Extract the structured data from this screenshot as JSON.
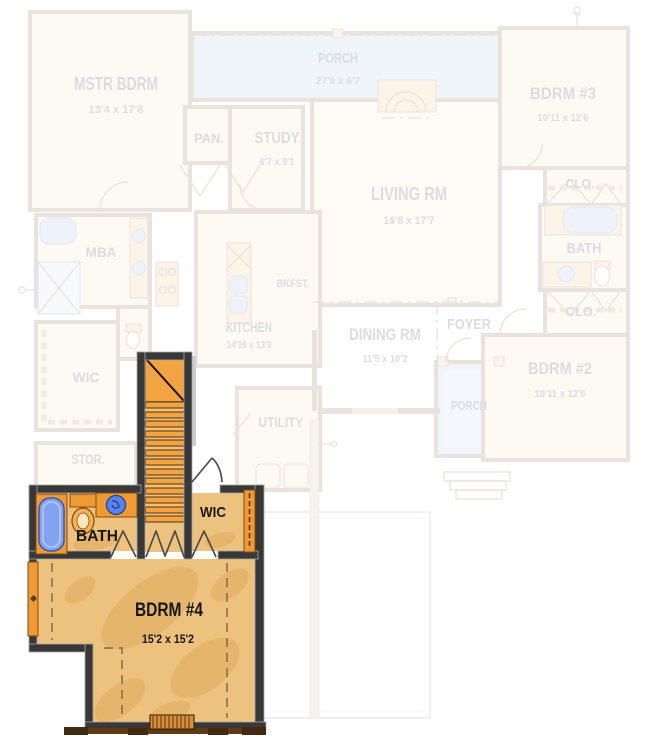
{
  "colors": {
    "page_bg": "#ffffff",
    "wall_dark": "#383838",
    "floor_tan": "#ecc27e",
    "floor_blob": "#e0ac5c",
    "stair_orange": "#f2a443",
    "stair_light": "#f7be72",
    "accent_orange": "#ed9b32",
    "accent_outline": "#8a4a10",
    "tub_blue": "#84a3ee",
    "tub_outline": "#3c56b4",
    "sink_blue": "#5b82e8",
    "sill_brown": "#5e3a17",
    "window_brown": "#d89038",
    "door_stroke": "#4d4d4d",
    "label_ink": "#161616",
    "faded_wall": "#7a5230",
    "faded_room": "#f7e3bd",
    "faded_room_light": "#fbeccf",
    "faded_porch": "#a9c4e4",
    "faded_porch_inner": "#c2d4ec",
    "faded_fixture": "#9db8ec",
    "faded_accent": "#f0c070",
    "faded_ink": "#2a2a44"
  },
  "floors": {
    "first_floor_faded": {
      "mstr_bdrm": {
        "label": "MSTR BDRM",
        "dims": "13'4 x 17'8"
      },
      "porch_front": {
        "label": "PORCH",
        "dims": "27'9 x 6'7"
      },
      "bdrm_3": {
        "label": "BDRM #3",
        "dims": "10'11 x 12'6"
      },
      "pantry": {
        "label": "PAN."
      },
      "study": {
        "label": "STUDY",
        "dims": "6'7 x 9'1"
      },
      "living_rm": {
        "label": "LIVING RM",
        "dims": "16'8 x 17'7"
      },
      "clo_upper": {
        "label": "CLO."
      },
      "bath": {
        "label": "BATH"
      },
      "clo_lower": {
        "label": "CLO."
      },
      "bdrm_2": {
        "label": "BDRM #2",
        "dims": "10'11 x 12'6"
      },
      "foyer": {
        "label": "FOYER"
      },
      "porch_rear": {
        "label": "PORCH"
      },
      "mba": {
        "label": "MBA"
      },
      "kitchen": {
        "label": "KITCHEN",
        "dims": "14'10 x 13'3"
      },
      "bkfst": {
        "label": "BKFST."
      },
      "dining_rm": {
        "label": "DINING RM",
        "dims": "11'5 x 10'2"
      },
      "wic": {
        "label": "WIC"
      },
      "stor": {
        "label": "STOR."
      },
      "utility": {
        "label": "UTILITY"
      }
    },
    "second_floor_highlighted": {
      "bath": {
        "label": "BATH"
      },
      "wic": {
        "label": "WIC"
      },
      "bdrm_4": {
        "label": "BDRM #4",
        "dims": "15'2 x 15'2"
      }
    }
  }
}
